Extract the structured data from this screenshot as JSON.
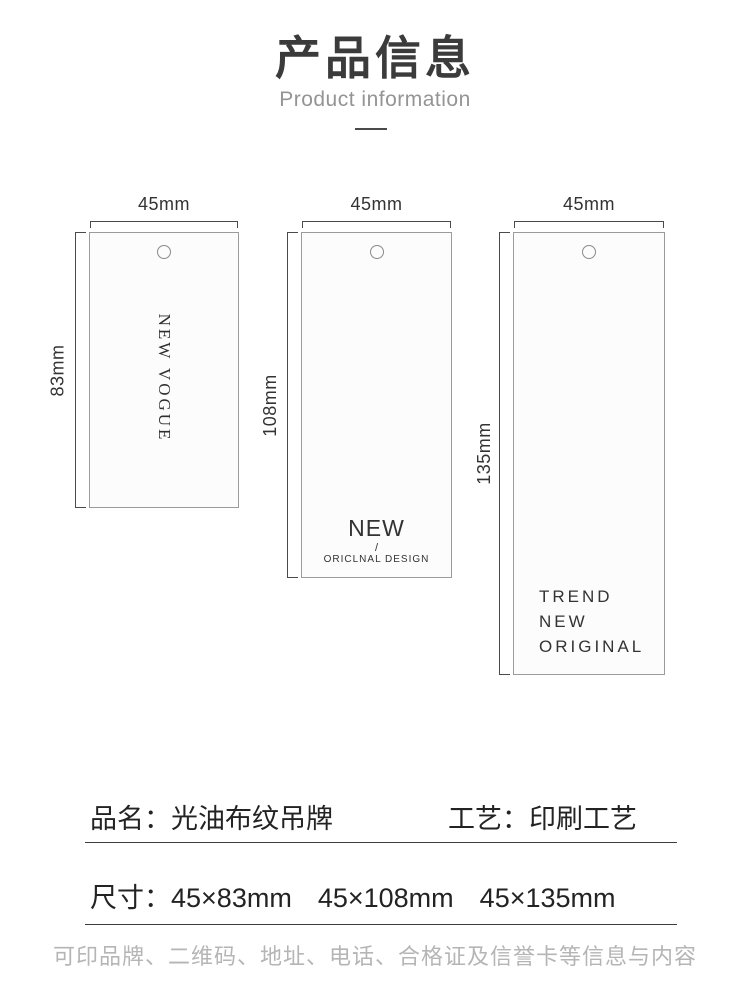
{
  "header": {
    "title": "产品信息",
    "subtitle": "Product information"
  },
  "diagram": {
    "tags": [
      {
        "width_label": "45mm",
        "height_label": "83mm",
        "vertical_text": "NEW VOGUE"
      },
      {
        "width_label": "45mm",
        "height_label": "108mm",
        "line1": "NEW",
        "slash": "/",
        "line2": "ORICLNAL DESIGN"
      },
      {
        "width_label": "45mm",
        "height_label": "135mm",
        "lines": [
          "TREND",
          "NEW",
          "ORIGINAL"
        ]
      }
    ]
  },
  "info": {
    "name_label": "品名：",
    "name_value": "光油布纹吊牌",
    "process_label": "工艺：",
    "process_value": "印刷工艺",
    "size_label": "尺寸：",
    "sizes": [
      "45×83mm",
      "45×108mm",
      "45×135mm"
    ],
    "note": "可印品牌、二维码、地址、电话、合格证及信誉卡等信息与内容"
  },
  "colors": {
    "accent_text": "#3b3b3b",
    "muted_text": "#949494",
    "note_text": "#b5b5b5",
    "line": "#3d3d3d",
    "tag_border": "#9b9b9b",
    "tag_fill": "#fcfcfc"
  }
}
